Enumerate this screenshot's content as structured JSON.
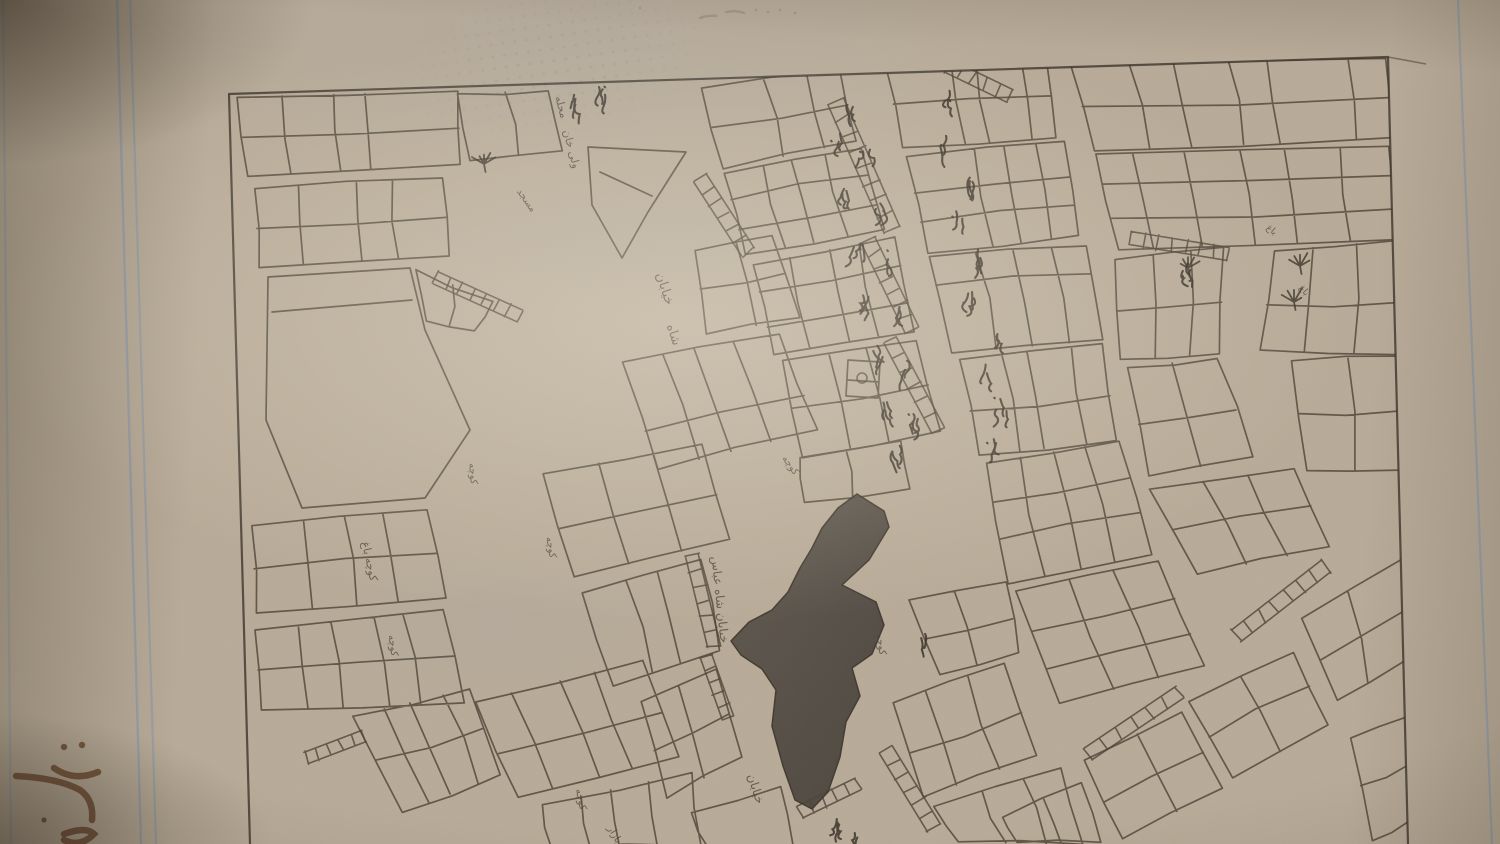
{
  "colors": {
    "paper": "#b9ac99",
    "ink": "#4f4538",
    "ink_dark": "#3c342a",
    "margin_blue": "#7d94b4",
    "highlight_dark": "#49433c",
    "highlight_light": "#5d564d",
    "note_ink": "#6f4e36",
    "pencil": "#8d8477"
  },
  "page": {
    "kind": "photographed ledger page with hand-drawn cadastral street map",
    "margin_rules": {
      "left": "double blue vertical rule",
      "right": "single blue vertical rule"
    }
  },
  "map": {
    "type": "hand-drawn parcel / street map, ink on paper",
    "labels": [
      {
        "text": "محله",
        "x": 558,
        "y": 108,
        "r": 75,
        "s": 11
      },
      {
        "text": "ولی خان",
        "x": 568,
        "y": 150,
        "r": 75,
        "s": 11
      },
      {
        "text": "مسجد",
        "x": 524,
        "y": 202,
        "r": 55,
        "s": 10
      },
      {
        "text": "خیابان",
        "x": 661,
        "y": 290,
        "r": 72,
        "s": 13
      },
      {
        "text": "شاه",
        "x": 670,
        "y": 336,
        "r": 72,
        "s": 13
      },
      {
        "text": "کوچه",
        "x": 788,
        "y": 467,
        "r": 55,
        "s": 10
      },
      {
        "text": "خیابان شاه عباس",
        "x": 716,
        "y": 600,
        "r": 84,
        "s": 12
      },
      {
        "text": "خیابان",
        "x": 752,
        "y": 790,
        "r": 72,
        "s": 12
      },
      {
        "text": "کوچه",
        "x": 878,
        "y": 645,
        "r": 80,
        "s": 10
      },
      {
        "text": "کوچه",
        "x": 548,
        "y": 548,
        "r": 80,
        "s": 10
      },
      {
        "text": "کوچه",
        "x": 470,
        "y": 474,
        "r": 85,
        "s": 10
      },
      {
        "text": "کوچه باغ",
        "x": 366,
        "y": 562,
        "r": 78,
        "s": 11
      },
      {
        "text": "کوچه",
        "x": 390,
        "y": 646,
        "r": 82,
        "s": 10
      },
      {
        "text": "کوچه",
        "x": 578,
        "y": 800,
        "r": 78,
        "s": 10
      },
      {
        "text": "بازار",
        "x": 612,
        "y": 836,
        "r": 60,
        "s": 10
      },
      {
        "text": "باغ",
        "x": 1270,
        "y": 232,
        "r": 40,
        "s": 9
      },
      {
        "text": "باغ",
        "x": 1302,
        "y": 292,
        "r": 50,
        "s": 9
      }
    ],
    "highlighted_parcel": {
      "description": "dark shaded irregular parcel near centre of map",
      "points": [
        [
          857,
          494
        ],
        [
          884,
          511
        ],
        [
          889,
          527
        ],
        [
          869,
          560
        ],
        [
          842,
          585
        ],
        [
          876,
          602
        ],
        [
          884,
          625
        ],
        [
          872,
          654
        ],
        [
          852,
          668
        ],
        [
          860,
          696
        ],
        [
          846,
          722
        ],
        [
          840,
          757
        ],
        [
          828,
          792
        ],
        [
          812,
          809
        ],
        [
          795,
          800
        ],
        [
          783,
          766
        ],
        [
          772,
          726
        ],
        [
          776,
          690
        ],
        [
          762,
          669
        ],
        [
          741,
          655
        ],
        [
          731,
          641
        ],
        [
          749,
          622
        ],
        [
          772,
          610
        ],
        [
          788,
          592
        ],
        [
          800,
          568
        ],
        [
          812,
          548
        ],
        [
          822,
          528
        ],
        [
          838,
          508
        ]
      ]
    }
  },
  "annotations": {
    "bottom_left_ink_note": {
      "medium": "brown ink handwriting",
      "legible": false,
      "cropped": true
    },
    "top_margin_pencil_marks": {
      "medium": "pencil scribble",
      "legible": false
    }
  }
}
